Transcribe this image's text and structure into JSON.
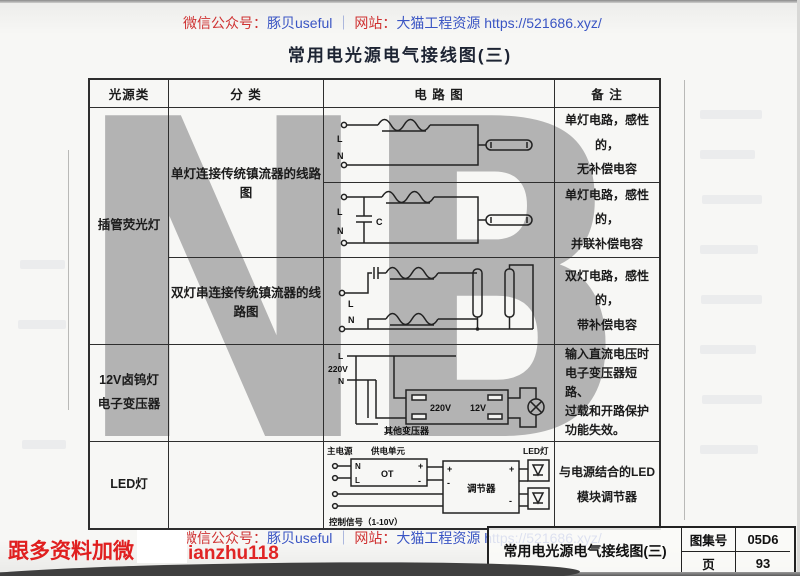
{
  "page_title": "常用电光源电气接线图(三)",
  "watermark_text": "NB",
  "header": {
    "wechat_label": "微信公众号：",
    "wechat_account": "豚贝useful",
    "separator": "｜",
    "site_label": "网站：",
    "site_name": "大猫工程资源",
    "site_url": "https://521686.xyz/"
  },
  "table": {
    "col_source": "光源类",
    "col_class": "分 类",
    "col_circuit": "电 路 图",
    "col_note": "备 注",
    "source_fluorescent": "插管荧光灯",
    "source_halogen": "12V卤钨灯\n电子变压器",
    "source_led": "LED灯",
    "class_single": "单灯连接传统镇流器的线路图",
    "class_double": "双灯串连接传统镇流器的线路图",
    "note1": "单灯电路，感性的，\n无补偿电容",
    "note2": "单灯电路，感性的，\n并联补偿电容",
    "note3": "双灯电路，感性的，\n带补偿电容",
    "note4": "输入直流电压时\n电子变压器短路、\n过载和开路保护\n功能失效。",
    "note5": "与电源结合的LED\n模块调节器"
  },
  "circuits": {
    "c1": {
      "l": "L",
      "n": "N"
    },
    "c2": {
      "l": "L",
      "n": "N",
      "cap": "C"
    },
    "c3": {
      "l": "L",
      "n": "N"
    },
    "c4": {
      "l": "L",
      "mid": "220V",
      "n": "N",
      "primary": "220V",
      "secondary": "12V",
      "other": "其他变压器"
    },
    "c5": {
      "mains": "主电源",
      "unit": "供电单元",
      "n": "N",
      "l": "L",
      "ot": "OT",
      "plus": "+",
      "minus": "-",
      "regulator": "调节器",
      "led": "LED灯",
      "signal": "控制信号（1-10V）"
    }
  },
  "footer": {
    "promo": "跟多资料加微",
    "account": "ianzhu118",
    "block_title": "常用电光源电气接线图(三)",
    "atlas_label": "图集号",
    "atlas_no": "05D6",
    "page_label": "页",
    "page_no": "93"
  },
  "colors": {
    "red": "#cf3232",
    "blue": "#3a55c4",
    "watermark_gray": "#a8a8a8"
  }
}
